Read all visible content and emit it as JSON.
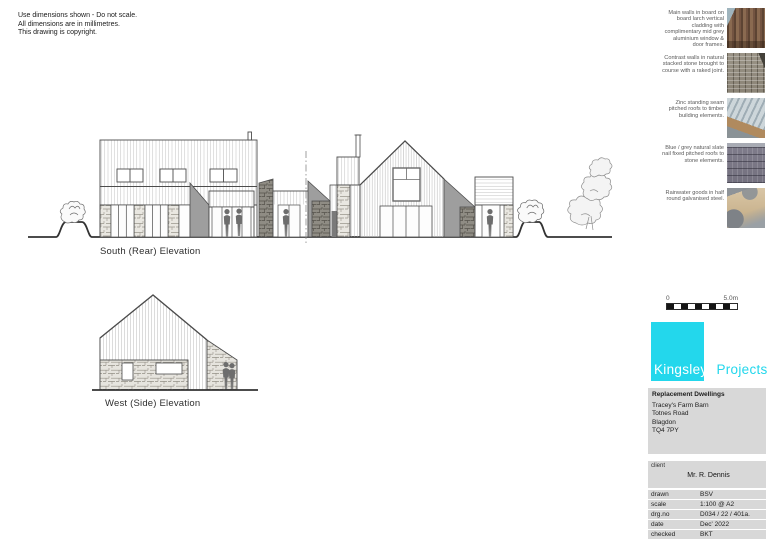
{
  "copyright_note": {
    "lines": [
      "Use dimensions shown - Do not scale.",
      "All dimensions are in millimetres.",
      "This drawing is copyright."
    ]
  },
  "elevations": [
    {
      "label": "South (Rear) Elevation"
    },
    {
      "label": "West (Side) Elevation"
    }
  ],
  "material_notes": [
    {
      "text": "Main walls in board on board larch vertical cladding with complimentary mid grey aluminium window & door frames.",
      "photo": "timber-cladding-photo"
    },
    {
      "text": "Contrast walls in natural stacked stone brought to course with a raked joint.",
      "photo": "stacked-stone-photo"
    },
    {
      "text": "Zinc standing seam pitched roofs to timber building elements.",
      "photo": "zinc-roof-photo"
    },
    {
      "text": "Blue / grey natural slate nail fixed pitched roofs to stone elements.",
      "photo": "slate-roof-photo"
    },
    {
      "text": "Rainwater goods in half round galvanised steel.",
      "photo": "rainwater-gutter-photo"
    }
  ],
  "scale_bar": {
    "start_label": "0",
    "end_label": "5.0m"
  },
  "title_block": {
    "logo": {
      "name_left": "Kingsley",
      "name_right": "Projects"
    },
    "project": {
      "title": "Replacement Dwellings",
      "address_lines": [
        "Tracey's Farm Barn",
        "Totnes Road",
        "Blagdon",
        "TQ4 7PY"
      ]
    },
    "client": {
      "label": "client",
      "name": "Mr. R. Dennis"
    },
    "info_rows": [
      {
        "label": "drawn",
        "value": "BSV"
      },
      {
        "label": "scale",
        "value": "1:100 @ A2"
      },
      {
        "label": "drg.no",
        "value": "D034 / 22 / 401a."
      },
      {
        "label": "date",
        "value": "Dec' 2022"
      },
      {
        "label": "checked",
        "value": "BKT"
      }
    ]
  },
  "colors": {
    "accent": "#23d7ec",
    "panel_grey": "#d8d8d8"
  }
}
